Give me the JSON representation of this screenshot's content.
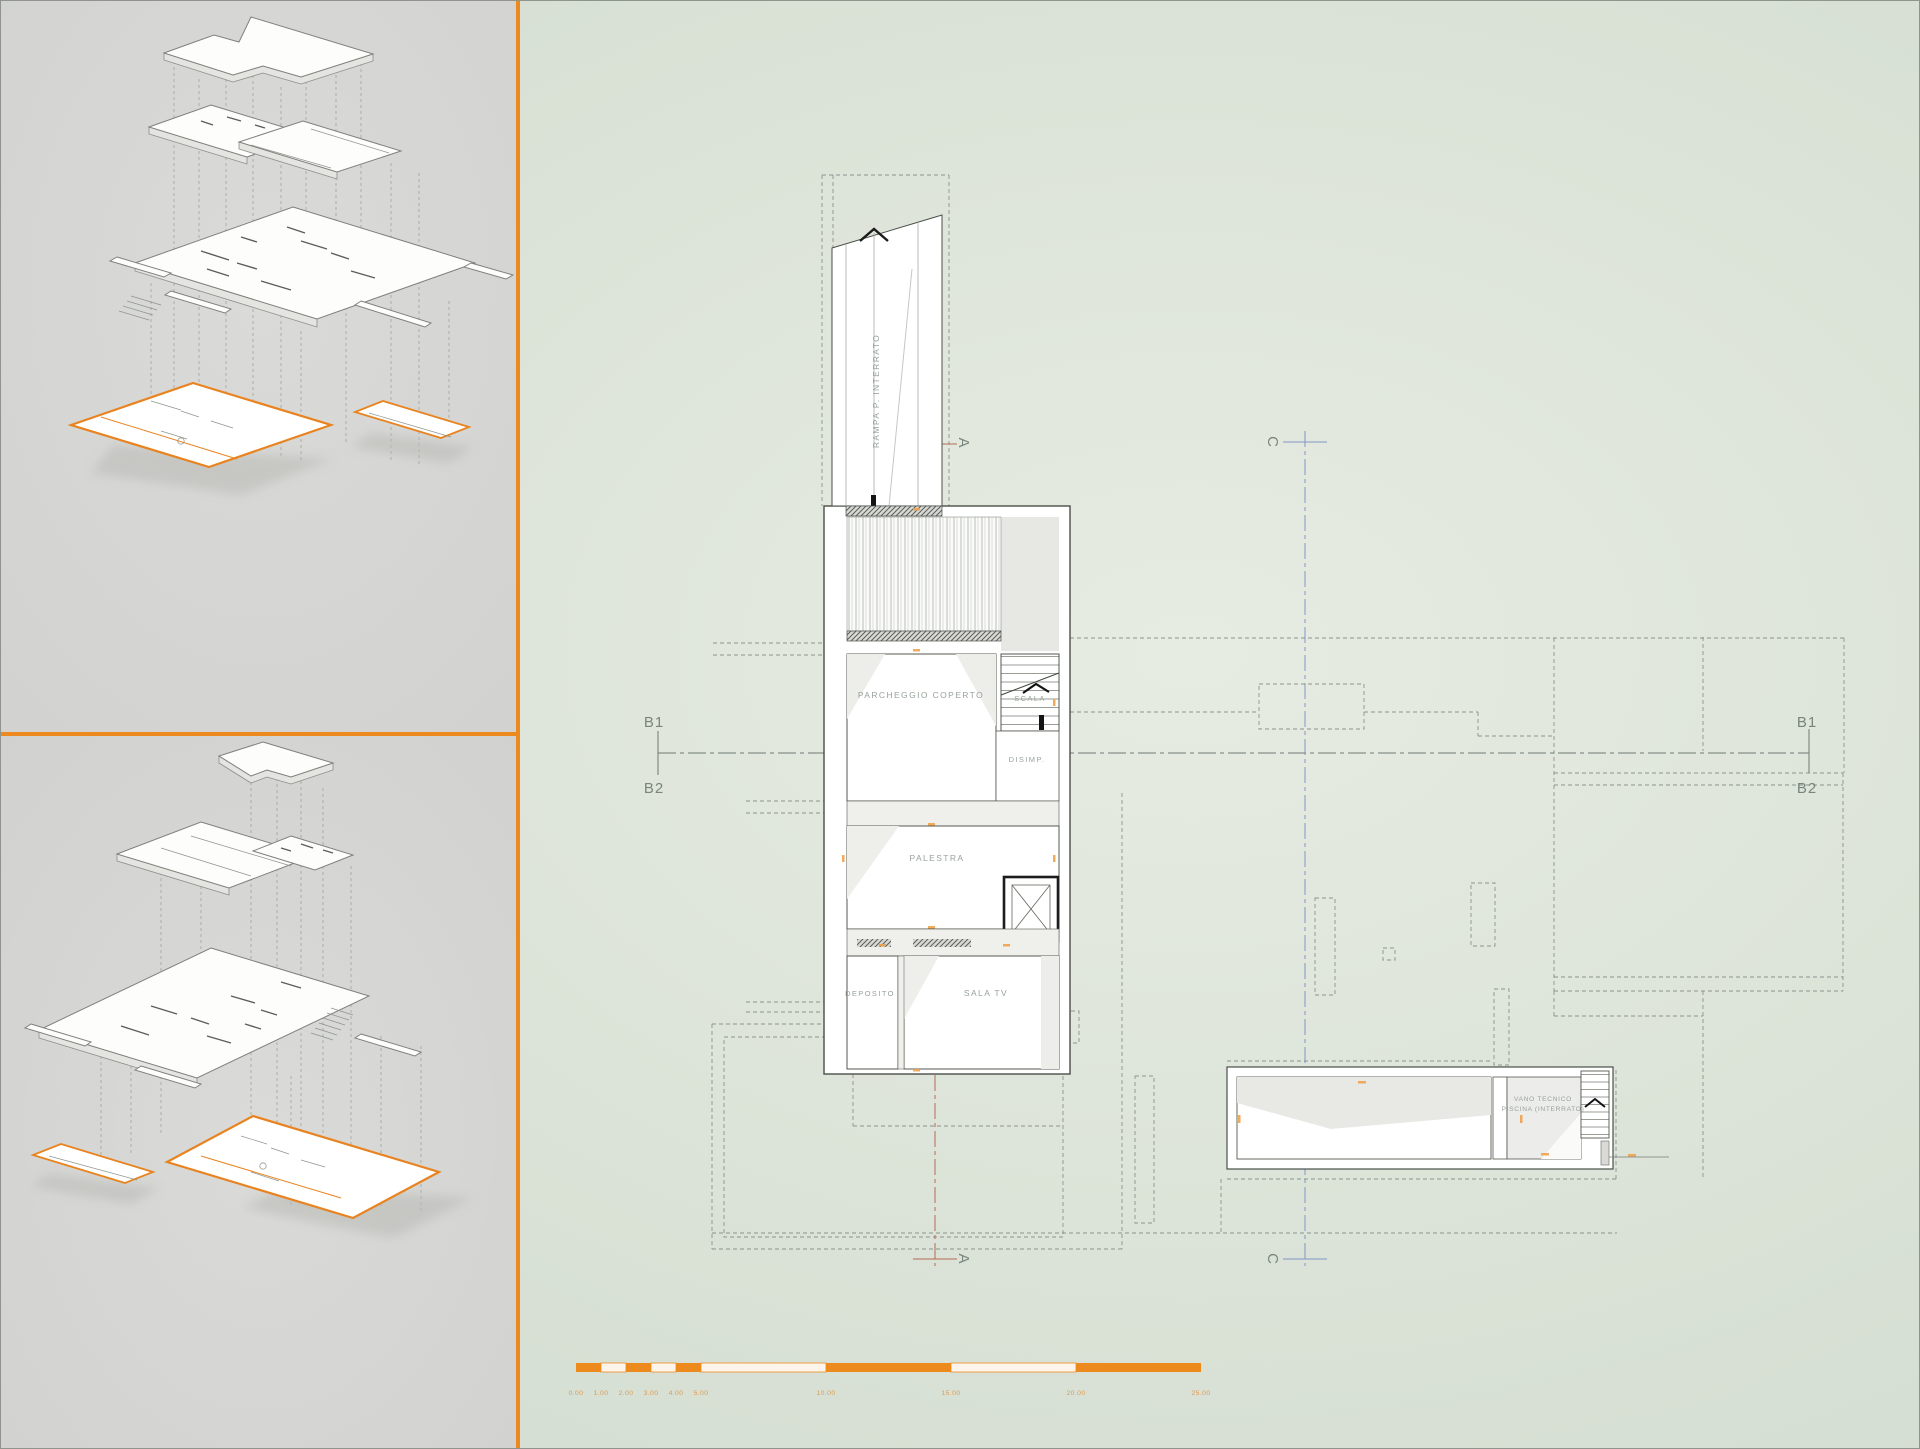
{
  "plan": {
    "rooms": {
      "rampa": "RAMPA P. INTERRATO",
      "parcheggio": "PARCHEGGIO COPERTO",
      "scala": "SCALA",
      "disimp": "DISIMP.",
      "palestra": "PALESTRA",
      "deposito": "DEPOSITO",
      "sala_tv": "SALA TV",
      "vano_tecnico_line1": "VANO TECNICO",
      "vano_tecnico_line2": "PISCINA (INTERRATO)"
    },
    "sections": {
      "b1": "B1",
      "b2": "B2",
      "a": "A",
      "c": "C"
    }
  },
  "scalebar": {
    "labels": [
      "0.00",
      "1.00",
      "2.00",
      "3.00",
      "4.00",
      "5.00",
      "10.00",
      "15.00",
      "20.00",
      "25.00"
    ]
  },
  "colors": {
    "accent_orange": "#ec8a1f",
    "background_green": "#dde4d9",
    "panel_gray": "#d6d6d4",
    "section_a_red": "#b66a52",
    "section_c_blue": "#8296c8",
    "drawing_line": "#4a4f48",
    "dashed_gray": "#8a948c",
    "label_gray": "#98a29a"
  }
}
